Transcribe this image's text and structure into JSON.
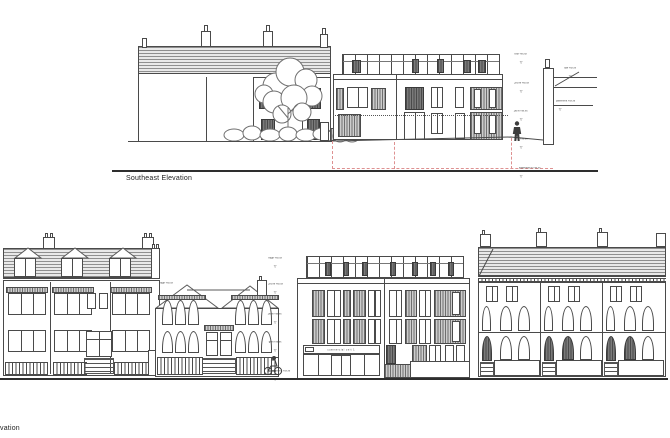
{
  "sheet": {
    "background": "#ffffff",
    "line_color": "#4a4a4a",
    "red_dash_color": "#de9191"
  },
  "icons": {
    "datum": "▽"
  },
  "top_drawing": {
    "title": "Southeast Elevation",
    "levels_left": [
      "roof +xx.xx",
      "2nd ffl +xx.xx",
      "1st ffl +xx.xx",
      "gf ffl +xx.xx",
      "basement ffl +xx.xx"
    ],
    "flag_a": "tow +xx.xx",
    "flag_b": "pavement +xx.xx"
  },
  "bottom_drawing": {
    "title": "vation",
    "ridge_flag": "ridge +xx.xx",
    "levels": [
      "ridge +xx.xx",
      "2nd ffl +xx.xx",
      "1st ffl +xx.xx",
      "gf ffl +xx.xx",
      "pavement +xx.xx"
    ],
    "shop_unit_no": "136",
    "shop_sign": "commercial unit 1"
  }
}
